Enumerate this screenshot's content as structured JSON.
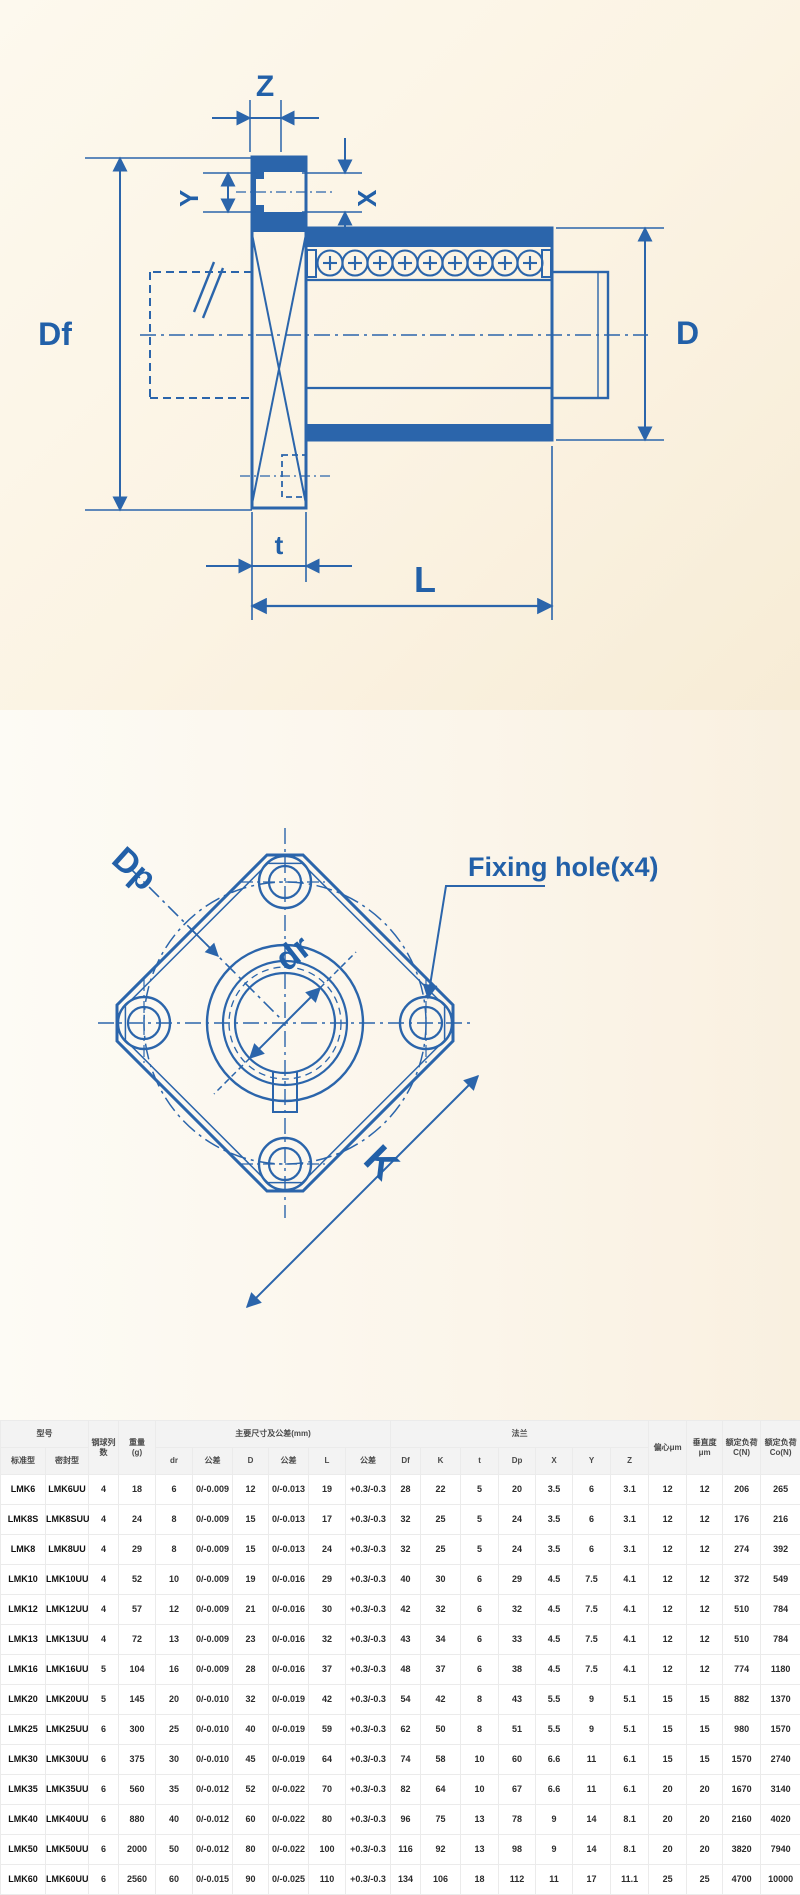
{
  "colors": {
    "line_blue": "#2b65ab",
    "label_blue": "#2260a8",
    "bg_top_cream": "#fbf3e3",
    "bg_mid_cream": "#fcf9f2",
    "table_header_bg": "#f3f3f3",
    "table_border": "#ebebeb"
  },
  "section_drawing": {
    "labels": {
      "z": "Z",
      "y": "Y",
      "x": "X",
      "df": "Df",
      "d": "D",
      "t": "t",
      "l": "L"
    }
  },
  "front_view": {
    "labels": {
      "dp": "Dp",
      "dr": "dr",
      "k": "K"
    },
    "callout": "Fixing hole(x4)"
  },
  "table": {
    "groups": {
      "model": "型号",
      "ball_rows": "钢球列数",
      "weight_l1": "重量",
      "weight_l2": "(g)",
      "dims": "主要尺寸及公差(mm)",
      "flange": "法兰",
      "ecc": "偏心μm",
      "perp_l1": "垂直度",
      "perp_l2": "μm",
      "c_l1": "额定负荷",
      "c_l2": "C(N)",
      "co_l1": "额定负荷",
      "co_l2": "Co(N)"
    },
    "sub": [
      "标准型",
      "密封型",
      "dr",
      "公差",
      "D",
      "公差",
      "L",
      "公差",
      "Df",
      "K",
      "t",
      "Dp",
      "X",
      "Y",
      "Z"
    ],
    "rows": [
      [
        "LMK6",
        "LMK6UU",
        "4",
        "18",
        "6",
        "0/-0.009",
        "12",
        "0/-0.013",
        "19",
        "+0.3/-0.3",
        "28",
        "22",
        "5",
        "20",
        "3.5",
        "6",
        "3.1",
        "12",
        "12",
        "206",
        "265"
      ],
      [
        "LMK8S",
        "LMK8SUU",
        "4",
        "24",
        "8",
        "0/-0.009",
        "15",
        "0/-0.013",
        "17",
        "+0.3/-0.3",
        "32",
        "25",
        "5",
        "24",
        "3.5",
        "6",
        "3.1",
        "12",
        "12",
        "176",
        "216"
      ],
      [
        "LMK8",
        "LMK8UU",
        "4",
        "29",
        "8",
        "0/-0.009",
        "15",
        "0/-0.013",
        "24",
        "+0.3/-0.3",
        "32",
        "25",
        "5",
        "24",
        "3.5",
        "6",
        "3.1",
        "12",
        "12",
        "274",
        "392"
      ],
      [
        "LMK10",
        "LMK10UU",
        "4",
        "52",
        "10",
        "0/-0.009",
        "19",
        "0/-0.016",
        "29",
        "+0.3/-0.3",
        "40",
        "30",
        "6",
        "29",
        "4.5",
        "7.5",
        "4.1",
        "12",
        "12",
        "372",
        "549"
      ],
      [
        "LMK12",
        "LMK12UU",
        "4",
        "57",
        "12",
        "0/-0.009",
        "21",
        "0/-0.016",
        "30",
        "+0.3/-0.3",
        "42",
        "32",
        "6",
        "32",
        "4.5",
        "7.5",
        "4.1",
        "12",
        "12",
        "510",
        "784"
      ],
      [
        "LMK13",
        "LMK13UU",
        "4",
        "72",
        "13",
        "0/-0.009",
        "23",
        "0/-0.016",
        "32",
        "+0.3/-0.3",
        "43",
        "34",
        "6",
        "33",
        "4.5",
        "7.5",
        "4.1",
        "12",
        "12",
        "510",
        "784"
      ],
      [
        "LMK16",
        "LMK16UU",
        "5",
        "104",
        "16",
        "0/-0.009",
        "28",
        "0/-0.016",
        "37",
        "+0.3/-0.3",
        "48",
        "37",
        "6",
        "38",
        "4.5",
        "7.5",
        "4.1",
        "12",
        "12",
        "774",
        "1180"
      ],
      [
        "LMK20",
        "LMK20UU",
        "5",
        "145",
        "20",
        "0/-0.010",
        "32",
        "0/-0.019",
        "42",
        "+0.3/-0.3",
        "54",
        "42",
        "8",
        "43",
        "5.5",
        "9",
        "5.1",
        "15",
        "15",
        "882",
        "1370"
      ],
      [
        "LMK25",
        "LMK25UU",
        "6",
        "300",
        "25",
        "0/-0.010",
        "40",
        "0/-0.019",
        "59",
        "+0.3/-0.3",
        "62",
        "50",
        "8",
        "51",
        "5.5",
        "9",
        "5.1",
        "15",
        "15",
        "980",
        "1570"
      ],
      [
        "LMK30",
        "LMK30UU",
        "6",
        "375",
        "30",
        "0/-0.010",
        "45",
        "0/-0.019",
        "64",
        "+0.3/-0.3",
        "74",
        "58",
        "10",
        "60",
        "6.6",
        "11",
        "6.1",
        "15",
        "15",
        "1570",
        "2740"
      ],
      [
        "LMK35",
        "LMK35UU",
        "6",
        "560",
        "35",
        "0/-0.012",
        "52",
        "0/-0.022",
        "70",
        "+0.3/-0.3",
        "82",
        "64",
        "10",
        "67",
        "6.6",
        "11",
        "6.1",
        "20",
        "20",
        "1670",
        "3140"
      ],
      [
        "LMK40",
        "LMK40UU",
        "6",
        "880",
        "40",
        "0/-0.012",
        "60",
        "0/-0.022",
        "80",
        "+0.3/-0.3",
        "96",
        "75",
        "13",
        "78",
        "9",
        "14",
        "8.1",
        "20",
        "20",
        "2160",
        "4020"
      ],
      [
        "LMK50",
        "LMK50UU",
        "6",
        "2000",
        "50",
        "0/-0.012",
        "80",
        "0/-0.022",
        "100",
        "+0.3/-0.3",
        "116",
        "92",
        "13",
        "98",
        "9",
        "14",
        "8.1",
        "20",
        "20",
        "3820",
        "7940"
      ],
      [
        "LMK60",
        "LMK60UU",
        "6",
        "2560",
        "60",
        "0/-0.015",
        "90",
        "0/-0.025",
        "110",
        "+0.3/-0.3",
        "134",
        "106",
        "18",
        "112",
        "11",
        "17",
        "11.1",
        "25",
        "25",
        "4700",
        "10000"
      ]
    ]
  }
}
